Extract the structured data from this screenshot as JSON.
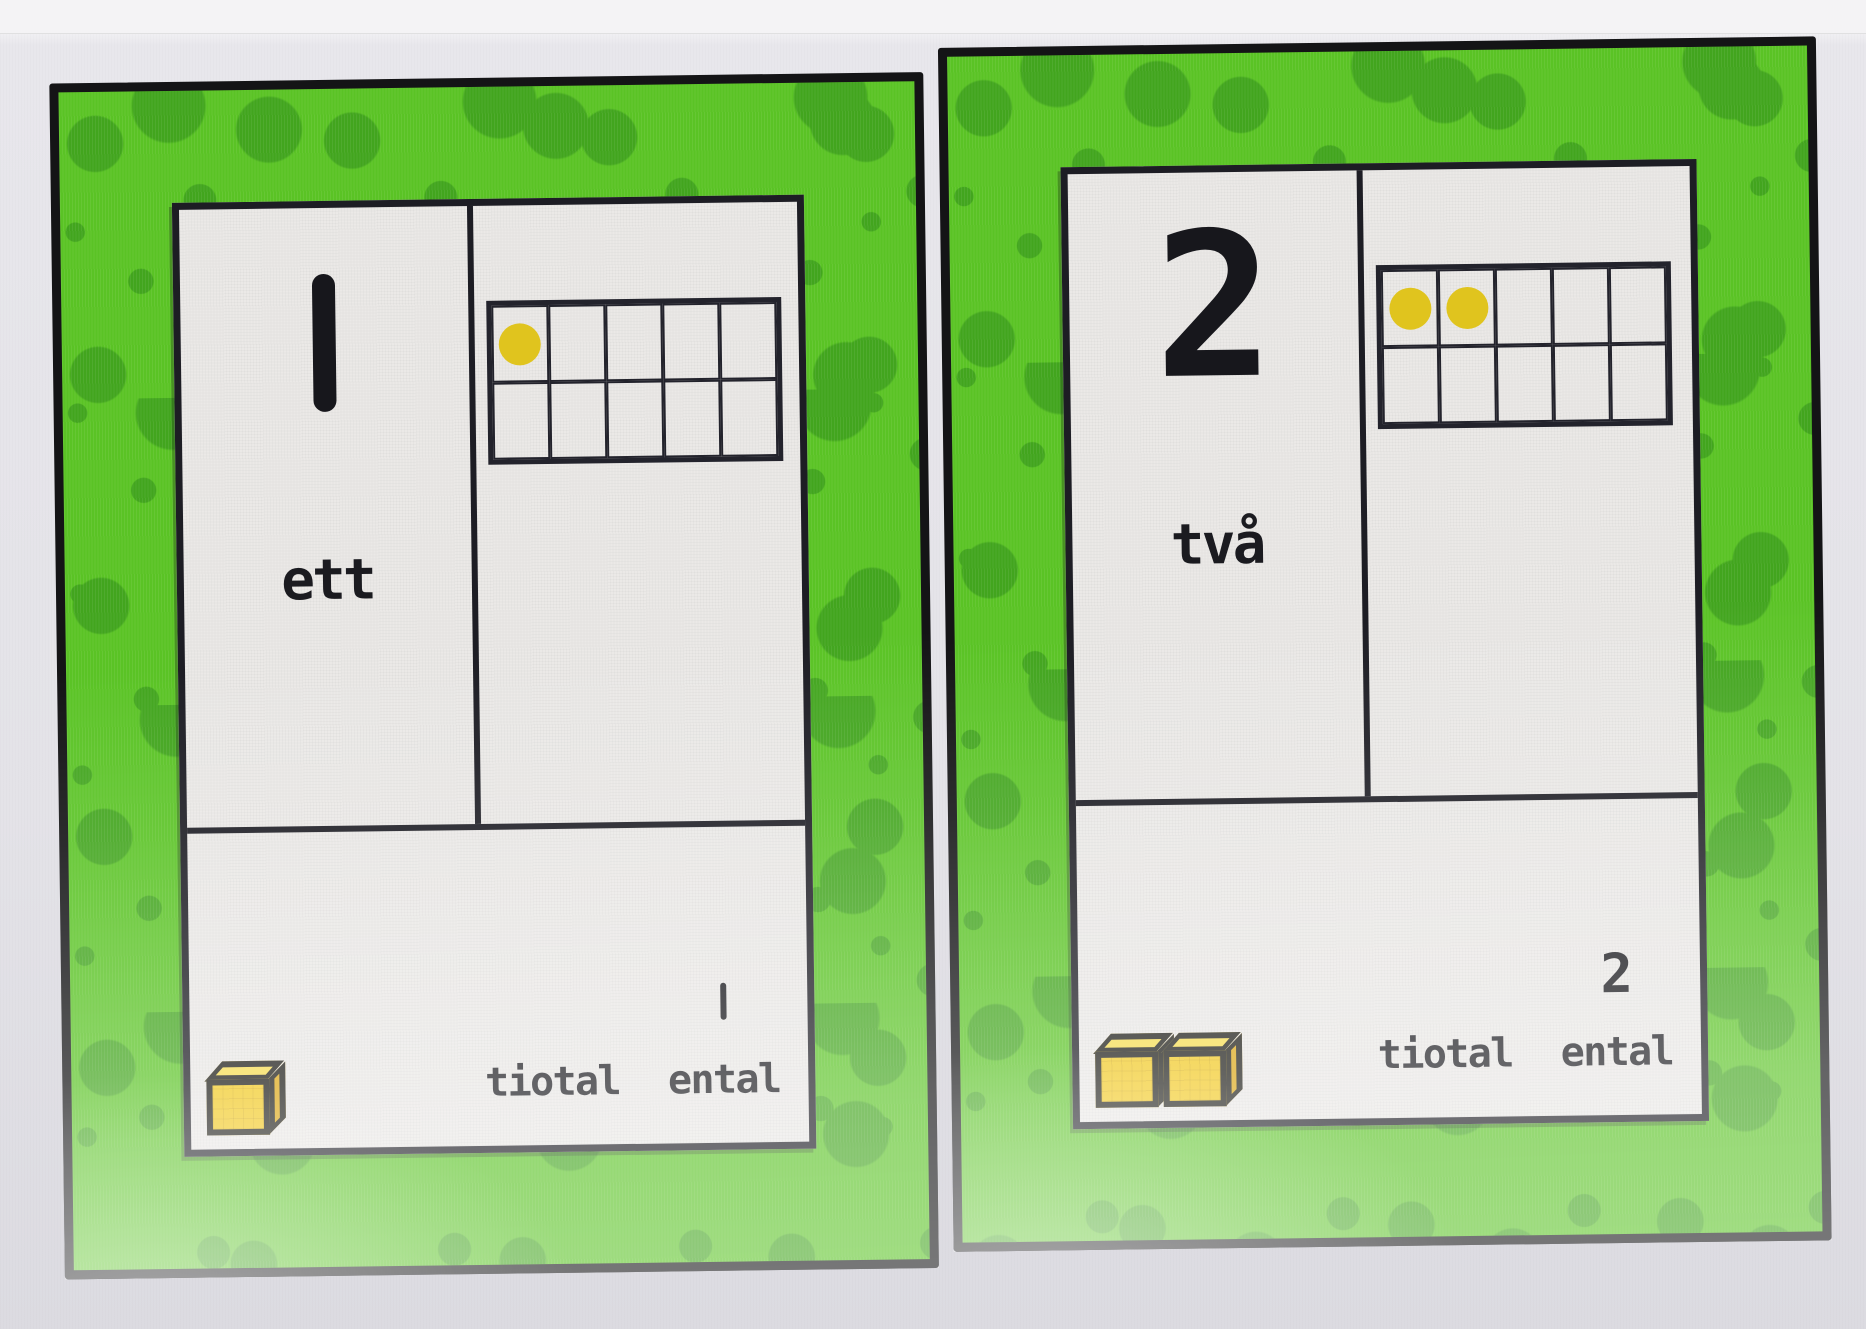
{
  "colors": {
    "page_bg": "#e4e3e8",
    "page_top_strip": "#f4f3f5",
    "card_border_green": "#5ac325",
    "card_dot_green": "#42a51e",
    "outline_black": "#1d1d24",
    "card_bg": "#ebe9e7",
    "counter_dot_yellow": "#e0c41e",
    "cube_yellow": "#f1c81e"
  },
  "cards": [
    {
      "id": "card-1",
      "numeral": "1",
      "number_word": "ett",
      "ten_frame": {
        "rows": 2,
        "cols": 5,
        "filled_dots": 1
      },
      "place_value": {
        "tens_label": "tiotal",
        "ones_label": "ental",
        "ones_digit": "1"
      },
      "unit_cubes": 1
    },
    {
      "id": "card-2",
      "numeral": "2",
      "number_word": "två",
      "ten_frame": {
        "rows": 2,
        "cols": 5,
        "filled_dots": 2
      },
      "place_value": {
        "tens_label": "tiotal",
        "ones_label": "ental",
        "ones_digit": "2"
      },
      "unit_cubes": 2
    }
  ]
}
